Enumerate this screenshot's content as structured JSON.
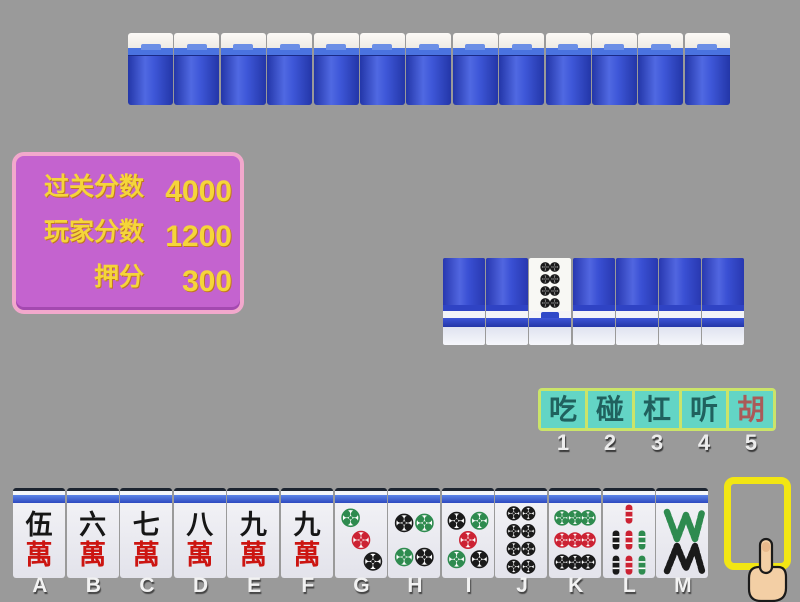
{
  "score_panel": {
    "rows": [
      {
        "label": "过关分数",
        "value": "4000"
      },
      {
        "label": "玩家分数",
        "value": "1200"
      },
      {
        "label": "押分",
        "value": "300"
      }
    ],
    "colors": {
      "background": "#c463cf",
      "border": "#f2a8cc",
      "text": "#f5d53a"
    }
  },
  "top_wall": {
    "tile_count": 13
  },
  "middle_wall": {
    "tiles": [
      {
        "face": "down"
      },
      {
        "face": "down"
      },
      {
        "face": "up",
        "suit": "dots",
        "value": 8
      },
      {
        "face": "down"
      },
      {
        "face": "down"
      },
      {
        "face": "down"
      },
      {
        "face": "down"
      }
    ]
  },
  "actions": {
    "buttons": [
      {
        "label": "吃",
        "number": "1"
      },
      {
        "label": "碰",
        "number": "2"
      },
      {
        "label": "杠",
        "number": "3"
      },
      {
        "label": "听",
        "number": "4"
      },
      {
        "label": "胡",
        "number": "5",
        "accent": true
      }
    ],
    "colors": {
      "background": "#63d5c5",
      "border": "#cbe469",
      "text": "#20615e",
      "hu_text": "#aa5a58"
    }
  },
  "hand": {
    "tiles": [
      {
        "label": "A",
        "suit": "wan",
        "value": 5,
        "char": "伍",
        "bottom_char": "萬"
      },
      {
        "label": "B",
        "suit": "wan",
        "value": 6,
        "char": "六",
        "bottom_char": "萬"
      },
      {
        "label": "C",
        "suit": "wan",
        "value": 7,
        "char": "七",
        "bottom_char": "萬"
      },
      {
        "label": "D",
        "suit": "wan",
        "value": 8,
        "char": "八",
        "bottom_char": "萬"
      },
      {
        "label": "E",
        "suit": "wan",
        "value": 9,
        "char": "九",
        "bottom_char": "萬"
      },
      {
        "label": "F",
        "suit": "wan",
        "value": 9,
        "char": "九",
        "bottom_char": "萬"
      },
      {
        "label": "G",
        "suit": "dots",
        "value": 3
      },
      {
        "label": "H",
        "suit": "dots",
        "value": 4
      },
      {
        "label": "I",
        "suit": "dots",
        "value": 5
      },
      {
        "label": "J",
        "suit": "dots",
        "value": 8
      },
      {
        "label": "K",
        "suit": "dots",
        "value": 9
      },
      {
        "label": "L",
        "suit": "bamboo",
        "value": 7
      },
      {
        "label": "M",
        "suit": "bamboo",
        "value": 8
      }
    ],
    "empty_slot_label": "N",
    "selection_color": "#f2e613"
  },
  "cursor": {
    "type": "pointing-hand"
  },
  "suit_colors": {
    "green": "#2e8b4f",
    "red": "#cc2233",
    "black": "#1a1a1a"
  }
}
